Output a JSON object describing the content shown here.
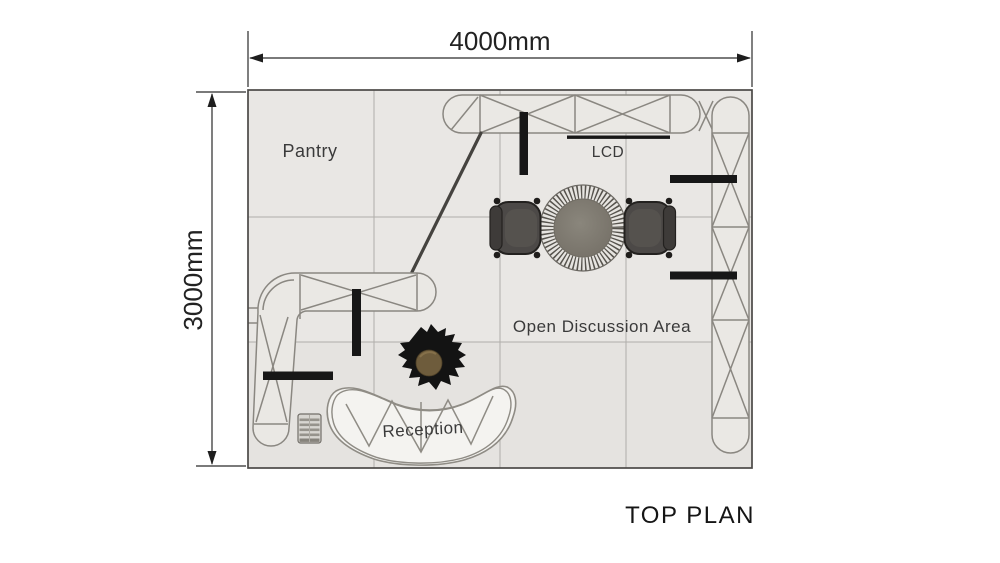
{
  "plan": {
    "title": "TOP PLAN",
    "dimension_width": "4000mm",
    "dimension_height": "3000mm",
    "areas": {
      "pantry": "Pantry",
      "lcd": "LCD",
      "open_discussion": "Open Discussion Area",
      "reception": "Reception"
    },
    "elements": [
      "back-wall-truss",
      "side-wall-truss",
      "l-shaped-counter-truss",
      "diagonal-truss-beam",
      "lcd-screen",
      "round-table",
      "armchairs",
      "person",
      "reception-desk",
      "waste-bin",
      "display-bars"
    ],
    "colors": {
      "background": "#ffffff",
      "floor": "#e9e7e4",
      "grid_line": "#b0aeaa",
      "plan_border": "#4b4947",
      "truss_line": "#8a8781",
      "black_element": "#171717",
      "chair": "#4c4947",
      "table_top": "#7e7a71",
      "person_head": "#6e5c3c",
      "dimension_text": "#222222",
      "label_text": "#3a3a3a"
    }
  }
}
